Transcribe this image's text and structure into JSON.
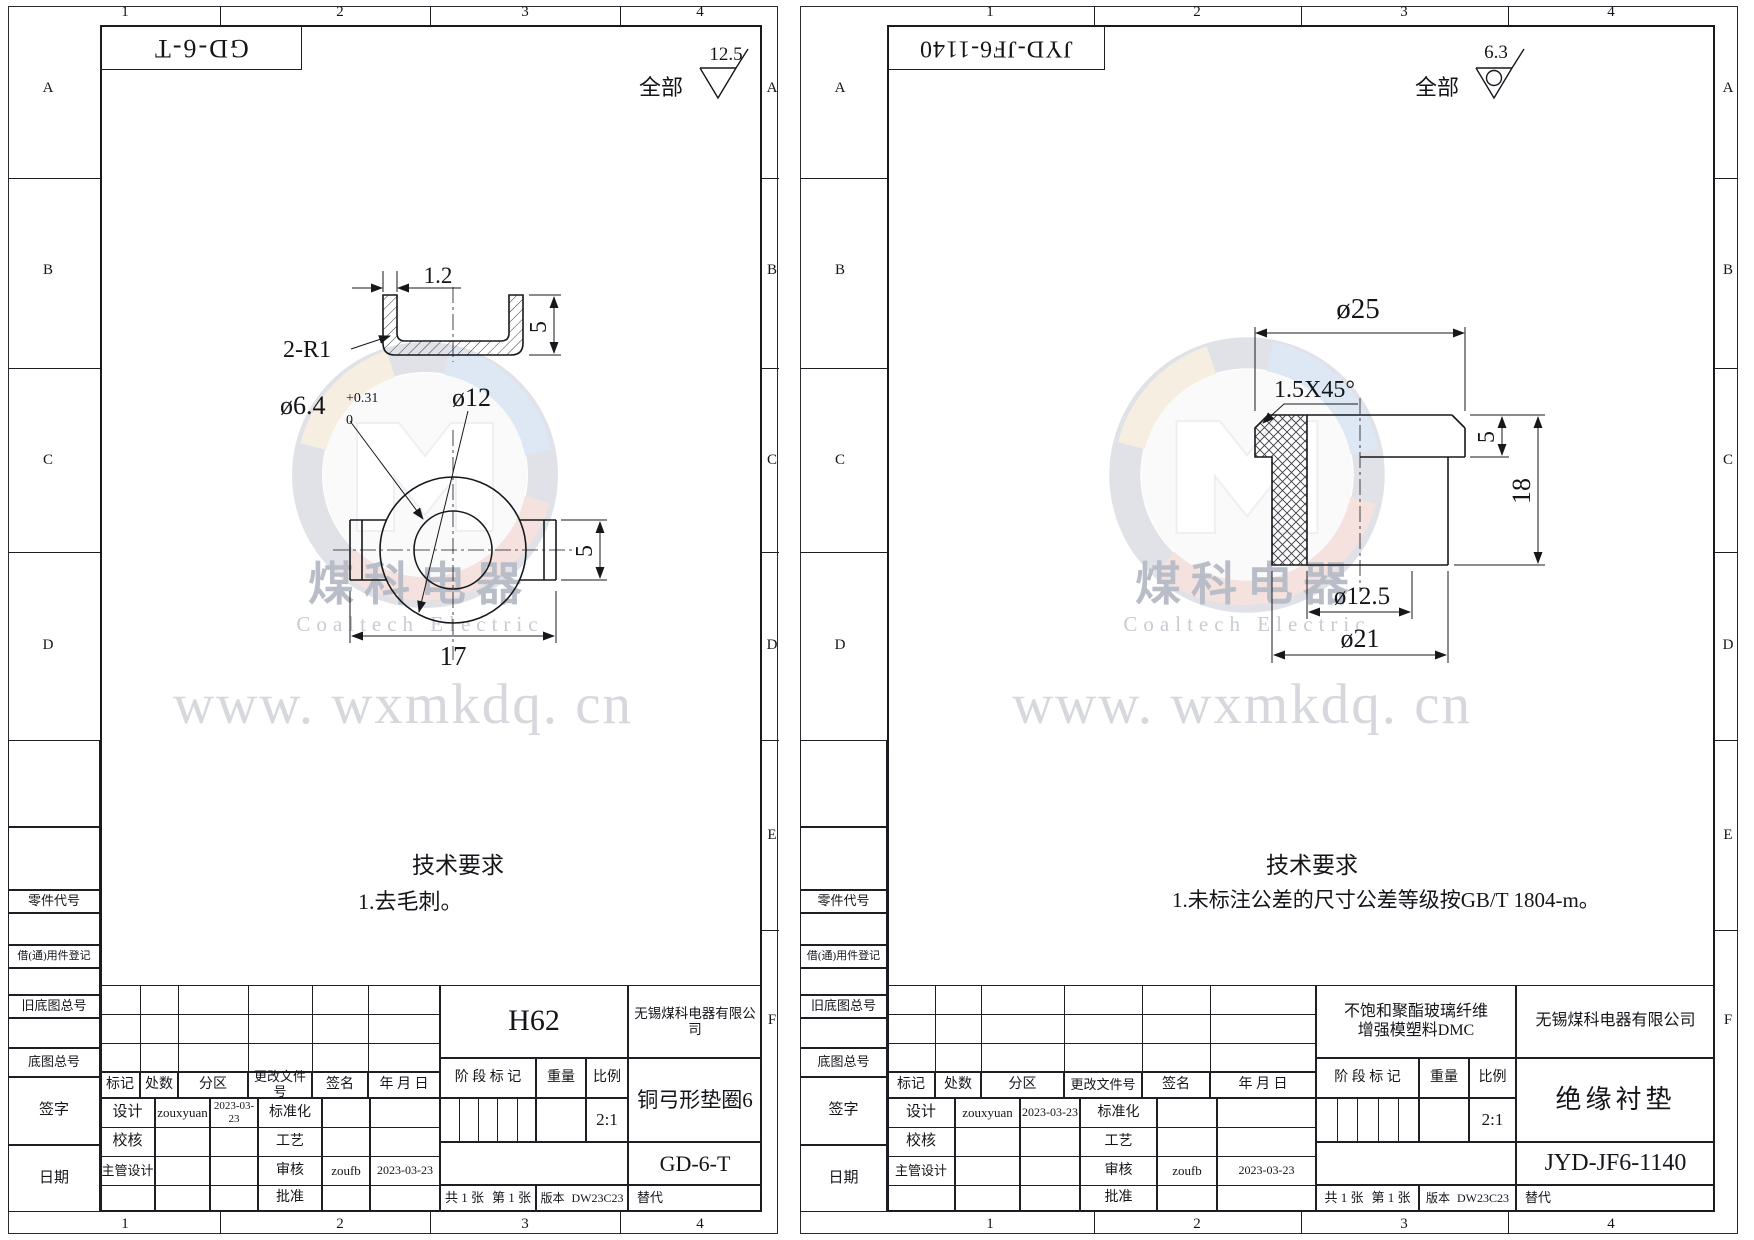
{
  "common": {
    "zones": {
      "cols": [
        "1",
        "2",
        "3",
        "4"
      ],
      "rows": [
        "A",
        "B",
        "C",
        "D",
        "E",
        "F"
      ]
    },
    "margin": {
      "part_code": "零件代号",
      "borrowed": "借(通)用件登记",
      "old_master_no": "旧底图总号",
      "master_no": "底图总号",
      "signature": "签字",
      "date": "日期"
    },
    "tb": {
      "mark": "标记",
      "count": "处数",
      "zone": "分区",
      "change_doc": "更改文件号",
      "sign": "签名",
      "ymd": "年 月 日",
      "design": "设计",
      "check": "校核",
      "chief_design": "主管设计",
      "standardize": "标准化",
      "process": "工艺",
      "audit": "审核",
      "approve": "批准",
      "stage_mark": "阶 段 标 记",
      "weight": "重量",
      "scale": "比例",
      "total_sheets": "共 1 张",
      "sheet_index": "第 1 张",
      "version": "版本",
      "substitute": "替代"
    },
    "watermark": {
      "brand": "煤科电器",
      "brand_en": "Coaltech Electric",
      "url": "www. wxmkdq. cn"
    },
    "surface_all": "全部"
  },
  "left": {
    "header_no": "GD-6-T",
    "roughness": "12.5",
    "tech_title": "技术要求",
    "tech_1": "1.去毛刺。",
    "material": "H62",
    "company": "无锡煤科电器有限公司",
    "part_name": "铜弓形垫圈6",
    "drawing_no": "GD-6-T",
    "scale_val": "2:1",
    "version_val": "DW23C23",
    "designer": "zouxyuan",
    "design_date": "2023-03-23",
    "auditor": "zoufb",
    "audit_date": "2023-03-23",
    "dims": {
      "t": "1.2",
      "r": "2-R1",
      "lip": "5",
      "hole": "ø6.4",
      "tol_up": "+0.31",
      "tol_dn": "0",
      "outer": "ø12",
      "width": "17",
      "tab": "5"
    }
  },
  "right": {
    "header_no": "JYD-JF6-1140",
    "roughness": "6.3",
    "tech_title": "技术要求",
    "tech_1": "1.未标注公差的尺寸公差等级按GB/T 1804-m。",
    "material_1": "不饱和聚酯玻璃纤维",
    "material_2": "增强模塑料DMC",
    "company": "无锡煤科电器有限公司",
    "part_name": "绝缘衬垫",
    "drawing_no": "JYD-JF6-1140",
    "scale_val": "2:1",
    "version_val": "DW23C23",
    "designer": "zouxyuan",
    "design_date": "2023-03-23",
    "auditor": "zoufb",
    "audit_date": "2023-03-23",
    "dims": {
      "flange_d": "ø25",
      "chamfer": "1.5X45°",
      "flange_h": "5",
      "height": "18",
      "hole": "ø12.5",
      "body_d": "ø21"
    }
  }
}
